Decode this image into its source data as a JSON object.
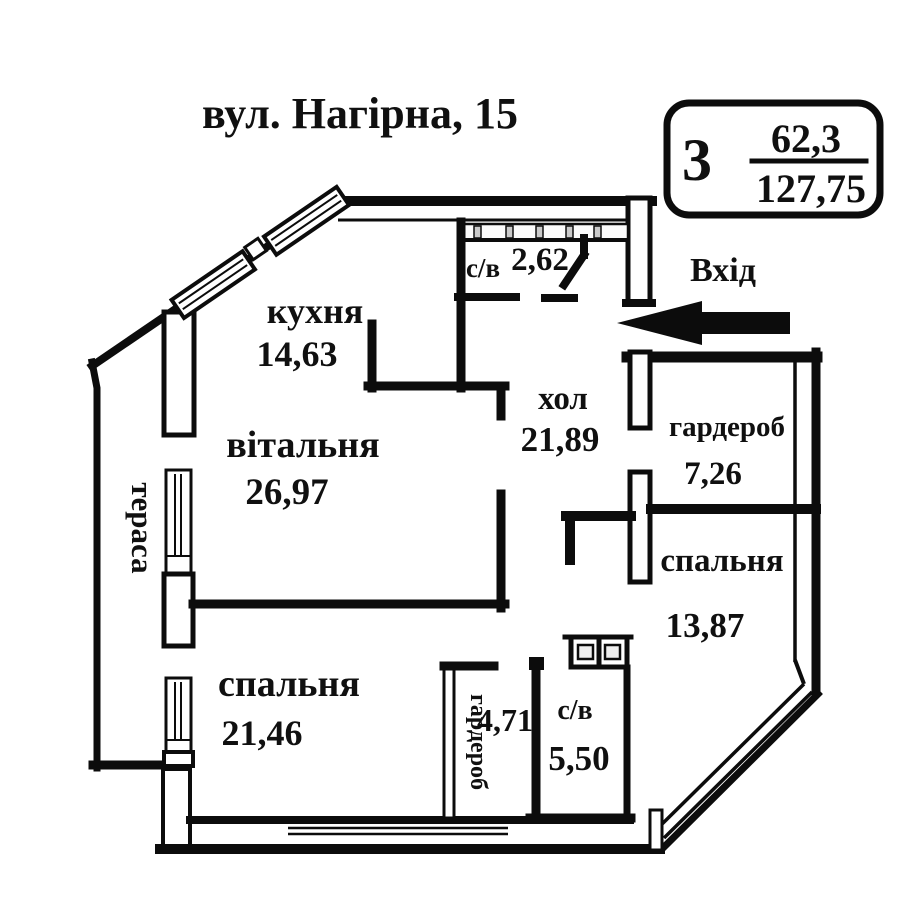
{
  "title": "вул. Нагірна, 15",
  "badge": {
    "rooms": "3",
    "area_living": "62,3",
    "area_total": "127,75"
  },
  "entrance": {
    "label": "Вхід"
  },
  "rooms": {
    "kitchen": {
      "name": "кухня",
      "area": "14,63"
    },
    "bath_top": {
      "name": "с/в",
      "area": "2,62"
    },
    "hall": {
      "name": "хол",
      "area": "21,89"
    },
    "wardrobe_right": {
      "name": "гардероб",
      "area": "7,26"
    },
    "living": {
      "name": "вітальня",
      "area": "26,97"
    },
    "terrace": {
      "name": "тераса"
    },
    "bedroom_right": {
      "name": "спальня",
      "area": "13,87"
    },
    "bedroom_bottom": {
      "name": "спальня",
      "area": "21,46"
    },
    "wardrobe_bottom": {
      "name": "гардероб",
      "area": "4,71"
    },
    "bath_bottom": {
      "name": "с/в",
      "area": "5,50"
    }
  },
  "colors": {
    "wall": "#0c0c0c",
    "background": "#ffffff",
    "text": "#101010"
  }
}
